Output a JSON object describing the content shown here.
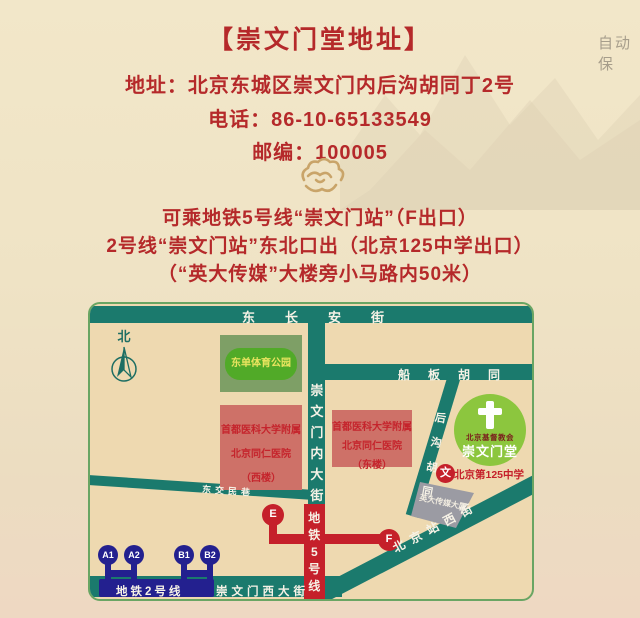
{
  "page": {
    "watermark": "自动保",
    "title": "【崇文门堂地址】",
    "info_lines": [
      "地址：北京东城区崇文门内后沟胡同丁2号",
      "电话：86-10-65133549",
      "邮编：100005"
    ],
    "directions": [
      "可乘地铁5号线“崇文门站”（F出口）",
      "2号线“崇文门站”东北口出（北京125中学出口）",
      "（“英大传媒”大楼旁小马路内50米）"
    ]
  },
  "map": {
    "north_label": "北",
    "roads": {
      "changan": "东长安街",
      "cwm_inner": "崇文门内大街",
      "chuanban": "船板胡同",
      "hougou": "后沟胡同",
      "bjz_west": "北京站西街",
      "dongjiaomin": "东交民巷",
      "cwm_west": "崇文门西大街"
    },
    "subway": {
      "line5": {
        "label": "地铁5号线",
        "stations": [
          "E",
          "F"
        ]
      },
      "line2": {
        "label": "地铁2号线",
        "stations": [
          "A1",
          "A2",
          "B1",
          "B2"
        ]
      }
    },
    "places": {
      "park": "东单体育公园",
      "hospital_west": {
        "lines": [
          "首都医科大学附属",
          "北京同仁医院",
          "（西楼）"
        ]
      },
      "hospital_east": {
        "lines": [
          "首都医科大学附属",
          "北京同仁医院",
          "（东楼）"
        ]
      },
      "yingda": "英大传媒大厦",
      "church": {
        "org": "北京基督教会",
        "name": "崇文门堂"
      },
      "school": {
        "marker": "文",
        "name": "北京第125中学"
      }
    }
  },
  "colors": {
    "accent_red": "#b5292a",
    "road_teal": "#1b7a6d",
    "line5_red": "#c5202a",
    "line2_navy": "#23208f",
    "church_green": "#8cc63e",
    "gold": "#c9a469"
  }
}
